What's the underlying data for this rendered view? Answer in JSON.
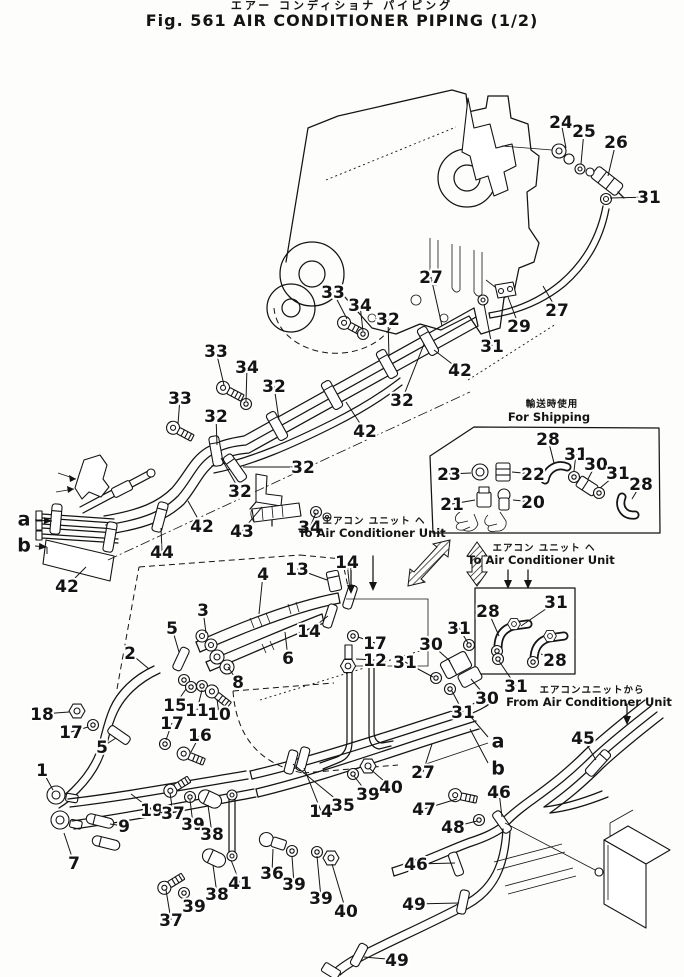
{
  "figure": {
    "title_jp": "エアー コンディショナ パイピング",
    "title_en": "Fig. 561  AIR  CONDITIONER  PIPING  (1/2)"
  },
  "theme": {
    "ink": "#141414",
    "paper": "#fdfdfb"
  },
  "annotations": [
    {
      "name": "for-shipping",
      "jp": "輸送時使用",
      "en": "For Shipping",
      "xj": 552,
      "yj": 407,
      "xe": 549,
      "ye": 421
    },
    {
      "name": "to-ac-unit-left",
      "jp": "エアコン ユニット ヘ",
      "en": "To Air Conditioner Unit",
      "xj": 374,
      "yj": 524,
      "xe": 372,
      "ye": 537
    },
    {
      "name": "to-ac-unit-right",
      "jp": "エアコン ユニット ヘ",
      "en": "To Air Conditioner Unit",
      "xj": 544,
      "yj": 551,
      "xe": 541,
      "ye": 564
    },
    {
      "name": "from-ac-unit",
      "jp": "エアコンユニットから",
      "en": "From Air Conditioner Unit",
      "xj": 592,
      "yj": 693,
      "xe": 589,
      "ye": 706
    }
  ],
  "view_labels": [
    {
      "label": "a",
      "x": 24,
      "y": 519,
      "x1": 35,
      "y1": 520,
      "x2": 52,
      "y2": 521,
      "arrow": true,
      "hook": false
    },
    {
      "label": "b",
      "x": 24,
      "y": 545,
      "x1": 35,
      "y1": 546,
      "x2": 47,
      "y2": 547,
      "arrow": true,
      "hook": true
    },
    {
      "label": "a",
      "x": 498,
      "y": 741,
      "x1": 488,
      "y1": 737,
      "x2": 471,
      "y2": 717,
      "arrow": false,
      "hook": false
    },
    {
      "label": "b",
      "x": 498,
      "y": 768,
      "x1": 488,
      "y1": 763,
      "x2": 470,
      "y2": 729,
      "arrow": false,
      "hook": false
    }
  ],
  "callouts": [
    {
      "label": "24",
      "x": 561,
      "y": 122,
      "tx": 566,
      "ty": 148
    },
    {
      "label": "25",
      "x": 584,
      "y": 131,
      "tx": 581,
      "ty": 164
    },
    {
      "label": "26",
      "x": 616,
      "y": 142,
      "tx": 608,
      "ty": 176
    },
    {
      "label": "31",
      "x": 649,
      "y": 197,
      "tx": 610,
      "ty": 198
    },
    {
      "label": "27",
      "x": 431,
      "y": 277,
      "tx": 442,
      "ty": 326
    },
    {
      "label": "29",
      "x": 519,
      "y": 326,
      "tx": 508,
      "ty": 297
    },
    {
      "label": "27",
      "x": 557,
      "y": 310,
      "tx": 543,
      "ty": 286
    },
    {
      "label": "31",
      "x": 492,
      "y": 346,
      "tx": 484,
      "ty": 304
    },
    {
      "label": "42",
      "x": 460,
      "y": 370,
      "tx": 434,
      "ty": 350
    },
    {
      "label": "33",
      "x": 333,
      "y": 292,
      "tx": 347,
      "ty": 319
    },
    {
      "label": "34",
      "x": 360,
      "y": 305,
      "tx": 363,
      "ty": 331
    },
    {
      "label": "32",
      "x": 388,
      "y": 319,
      "tx": 389,
      "ty": 357
    },
    {
      "label": "32",
      "x": 402,
      "y": 400,
      "tx": 424,
      "ty": 344
    },
    {
      "label": "42",
      "x": 365,
      "y": 431,
      "tx": 346,
      "ty": 402
    },
    {
      "label": "33",
      "x": 216,
      "y": 351,
      "tx": 224,
      "ty": 385
    },
    {
      "label": "34",
      "x": 247,
      "y": 367,
      "tx": 246,
      "ty": 401
    },
    {
      "label": "32",
      "x": 274,
      "y": 386,
      "tx": 279,
      "ty": 420
    },
    {
      "label": "33",
      "x": 180,
      "y": 398,
      "tx": 178,
      "ty": 424
    },
    {
      "label": "32",
      "x": 216,
      "y": 416,
      "tx": 217,
      "ty": 445
    },
    {
      "label": "32",
      "x": 303,
      "y": 467,
      "tx": 243,
      "ty": 467
    },
    {
      "label": "32",
      "x": 240,
      "y": 491,
      "tx": 221,
      "ty": 458
    },
    {
      "label": "42",
      "x": 202,
      "y": 526,
      "tx": 188,
      "ty": 501
    },
    {
      "label": "43",
      "x": 242,
      "y": 531,
      "tx": 262,
      "ty": 507
    },
    {
      "label": "34",
      "x": 310,
      "y": 527,
      "tx": 316,
      "ty": 513
    },
    {
      "label": "44",
      "x": 162,
      "y": 552,
      "tx": 161,
      "ty": 528
    },
    {
      "label": "42",
      "x": 67,
      "y": 586,
      "tx": 86,
      "ty": 567
    },
    {
      "label": "13",
      "x": 297,
      "y": 569,
      "tx": 327,
      "ty": 580
    },
    {
      "label": "14",
      "x": 347,
      "y": 562,
      "tx": 350,
      "ty": 591
    },
    {
      "label": "4",
      "x": 263,
      "y": 574,
      "tx": 259,
      "ty": 614
    },
    {
      "label": "14",
      "x": 309,
      "y": 631,
      "tx": 328,
      "ty": 616
    },
    {
      "label": "17",
      "x": 375,
      "y": 643,
      "tx": 358,
      "ty": 637
    },
    {
      "label": "12",
      "x": 375,
      "y": 660,
      "tx": 356,
      "ty": 659
    },
    {
      "label": "6",
      "x": 288,
      "y": 658,
      "tx": 285,
      "ty": 632
    },
    {
      "label": "3",
      "x": 203,
      "y": 610,
      "tx": 206,
      "ty": 633
    },
    {
      "label": "5",
      "x": 172,
      "y": 628,
      "tx": 179,
      "ty": 652
    },
    {
      "label": "8",
      "x": 238,
      "y": 682,
      "tx": 228,
      "ty": 667
    },
    {
      "label": "2",
      "x": 130,
      "y": 653,
      "tx": 149,
      "ty": 669
    },
    {
      "label": "15",
      "x": 175,
      "y": 705,
      "tx": 186,
      "ty": 689
    },
    {
      "label": "11",
      "x": 197,
      "y": 710,
      "tx": 202,
      "ty": 690
    },
    {
      "label": "10",
      "x": 219,
      "y": 714,
      "tx": 217,
      "ty": 699
    },
    {
      "label": "18",
      "x": 42,
      "y": 714,
      "tx": 69,
      "ty": 712
    },
    {
      "label": "17",
      "x": 71,
      "y": 732,
      "tx": 88,
      "ty": 727
    },
    {
      "label": "5",
      "x": 102,
      "y": 747,
      "tx": 116,
      "ty": 738
    },
    {
      "label": "17",
      "x": 172,
      "y": 723,
      "tx": 166,
      "ty": 740
    },
    {
      "label": "16",
      "x": 200,
      "y": 735,
      "tx": 191,
      "ty": 752
    },
    {
      "label": "1",
      "x": 42,
      "y": 770,
      "tx": 53,
      "ty": 790
    },
    {
      "label": "19",
      "x": 152,
      "y": 810,
      "tx": 131,
      "ty": 794
    },
    {
      "label": "9",
      "x": 124,
      "y": 826,
      "tx": 110,
      "ty": 824
    },
    {
      "label": "7",
      "x": 74,
      "y": 863,
      "tx": 64,
      "ty": 833
    },
    {
      "label": "37",
      "x": 173,
      "y": 813,
      "tx": 170,
      "ty": 793
    },
    {
      "label": "39",
      "x": 193,
      "y": 824,
      "tx": 190,
      "ty": 800
    },
    {
      "label": "38",
      "x": 212,
      "y": 834,
      "tx": 208,
      "ty": 805
    },
    {
      "label": "37",
      "x": 171,
      "y": 920,
      "tx": 166,
      "ty": 890
    },
    {
      "label": "39",
      "x": 194,
      "y": 906,
      "tx": 186,
      "ty": 897
    },
    {
      "label": "38",
      "x": 217,
      "y": 894,
      "tx": 213,
      "ty": 865
    },
    {
      "label": "41",
      "x": 240,
      "y": 883,
      "tx": 231,
      "ty": 860
    },
    {
      "label": "36",
      "x": 272,
      "y": 873,
      "tx": 273,
      "ty": 849
    },
    {
      "label": "39",
      "x": 294,
      "y": 884,
      "tx": 292,
      "ty": 856
    },
    {
      "label": "39",
      "x": 321,
      "y": 898,
      "tx": 317,
      "ty": 856
    },
    {
      "label": "40",
      "x": 346,
      "y": 911,
      "tx": 332,
      "ty": 864
    },
    {
      "label": "14",
      "x": 321,
      "y": 811,
      "tx": 304,
      "ty": 768
    },
    {
      "label": "35",
      "x": 343,
      "y": 805,
      "tx": 293,
      "ty": 764
    },
    {
      "label": "39",
      "x": 368,
      "y": 794,
      "tx": 354,
      "ty": 776
    },
    {
      "label": "40",
      "x": 391,
      "y": 787,
      "tx": 369,
      "ty": 768
    },
    {
      "label": "27",
      "x": 423,
      "y": 772,
      "tx": 432,
      "ty": 744
    },
    {
      "label": "47",
      "x": 424,
      "y": 809,
      "tx": 457,
      "ty": 799
    },
    {
      "label": "48",
      "x": 453,
      "y": 827,
      "tx": 477,
      "ty": 821
    },
    {
      "label": "46",
      "x": 416,
      "y": 864,
      "tx": 455,
      "ty": 863
    },
    {
      "label": "49",
      "x": 414,
      "y": 904,
      "tx": 459,
      "ty": 903
    },
    {
      "label": "49",
      "x": 397,
      "y": 960,
      "tx": 364,
      "ty": 957
    },
    {
      "label": "45",
      "x": 583,
      "y": 738,
      "tx": 596,
      "ty": 760
    },
    {
      "label": "46",
      "x": 499,
      "y": 792,
      "tx": 502,
      "ty": 817
    },
    {
      "label": "31",
      "x": 459,
      "y": 628,
      "tx": 468,
      "ty": 643
    },
    {
      "label": "30",
      "x": 431,
      "y": 644,
      "tx": 450,
      "ty": 661
    },
    {
      "label": "31",
      "x": 405,
      "y": 662,
      "tx": 433,
      "ty": 677
    },
    {
      "label": "30",
      "x": 487,
      "y": 698,
      "tx": 471,
      "ty": 679
    },
    {
      "label": "31",
      "x": 463,
      "y": 712,
      "tx": 452,
      "ty": 691
    },
    {
      "label": "31",
      "x": 516,
      "y": 686,
      "tx": 499,
      "ty": 661
    },
    {
      "label": "28",
      "x": 488,
      "y": 611,
      "tx": 499,
      "ty": 636
    },
    {
      "label": "31",
      "x": 556,
      "y": 602,
      "tx": 521,
      "ty": 626
    },
    {
      "label": "28",
      "x": 555,
      "y": 660,
      "tx": 541,
      "ty": 654
    },
    {
      "label": "23",
      "x": 449,
      "y": 474,
      "tx": 471,
      "ty": 473
    },
    {
      "label": "22",
      "x": 533,
      "y": 474,
      "tx": 512,
      "ty": 472
    },
    {
      "label": "21",
      "x": 452,
      "y": 504,
      "tx": 475,
      "ty": 500
    },
    {
      "label": "20",
      "x": 533,
      "y": 502,
      "tx": 513,
      "ty": 500
    },
    {
      "label": "28",
      "x": 548,
      "y": 439,
      "tx": 554,
      "ty": 463
    },
    {
      "label": "31",
      "x": 576,
      "y": 454,
      "tx": 574,
      "ty": 471
    },
    {
      "label": "30",
      "x": 596,
      "y": 464,
      "tx": 588,
      "ty": 479
    },
    {
      "label": "31",
      "x": 618,
      "y": 473,
      "tx": 600,
      "ty": 488
    },
    {
      "label": "28",
      "x": 641,
      "y": 484,
      "tx": 632,
      "ty": 499
    }
  ]
}
